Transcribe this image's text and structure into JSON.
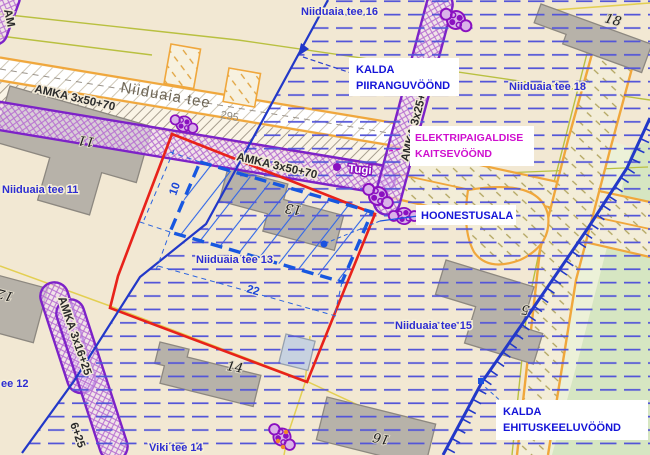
{
  "street": {
    "name": "Niiduaia tee",
    "number": "295"
  },
  "parcel_labels": {
    "tee16": "Niiduaia tee 16",
    "tee18": "Niiduaia tee 18",
    "tee11": "Niiduaia tee 11",
    "tee13": "Niiduaia tee 13",
    "tee15": "Niiduaia tee 15",
    "tee12_partial": "ee 12",
    "viki14": "Viki tee 14"
  },
  "building_numbers": {
    "n11": "11",
    "n12": "12",
    "n13": "13",
    "n14": "14",
    "n16": "16",
    "n5": "5",
    "n18": "18"
  },
  "cable_labels": {
    "amka50_a": "AMKA 3x50+70",
    "amka50_b": "AMKA 3x50+70",
    "amka25": "AMKA 3x25+35",
    "amka16": "AMKA 3x16+25",
    "amka16_partial": "6+25",
    "support": "Tugi",
    "partial_top_left": "AM"
  },
  "callouts": {
    "kalda_piiranguvoond": {
      "line1": "KALDA",
      "line2": "PIIRANGUVÖÖND",
      "color": "#1515d8"
    },
    "elektripaigaldise_kaitsevoond": {
      "line1": "ELEKTRIPAIGALDISE",
      "line2": "KAITSEVÖÖND",
      "color": "#cf0fcf"
    },
    "hoonestusala": {
      "line1": "HOONESTUSALA",
      "color": "#1515d8"
    },
    "kalda_ehituskeeluvoond": {
      "line1": "KALDA",
      "line2": "EHITUSKEELUVÖÖND",
      "color": "#1515d8"
    }
  },
  "dimensions": {
    "building_area_width_m": "22",
    "building_area_depth_m": "10"
  },
  "legend_colors": {
    "planning_boundary_red": "#e8221a",
    "restriction_line_blue": "#2238c8",
    "building_area_blue": "#1757e0",
    "cable_zone_purple": "#8a10c0",
    "cadastral_yellow": "#e3cf52",
    "road_edge_orange": "#f0a73c",
    "electric_label_magenta": "#cf0fcf"
  }
}
